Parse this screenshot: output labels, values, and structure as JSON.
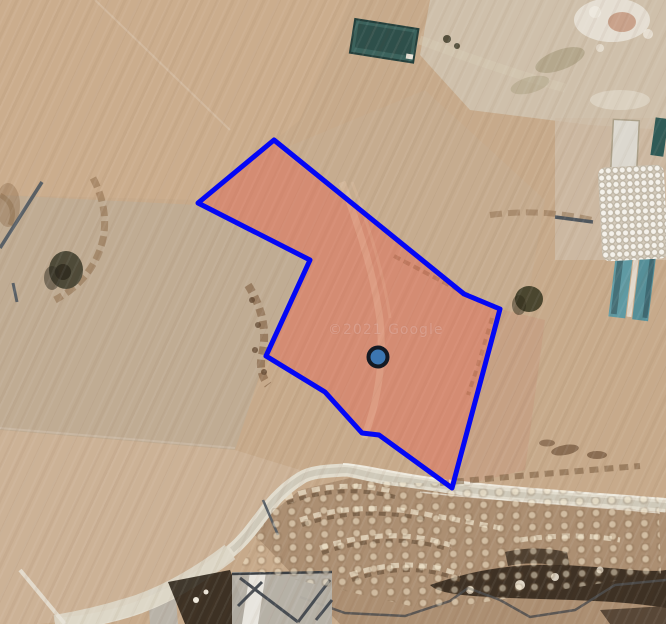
{
  "map": {
    "watermark": "©2021 Google",
    "overlay": {
      "parcel_polygon": {
        "points": [
          [
            274,
            140
          ],
          [
            198,
            203
          ],
          [
            310,
            260
          ],
          [
            266,
            356
          ],
          [
            325,
            392
          ],
          [
            362,
            433
          ],
          [
            379,
            435
          ],
          [
            452,
            488
          ],
          [
            500,
            309
          ],
          [
            464,
            294
          ]
        ],
        "stroke_color": "#0407f5",
        "fill_color": "rgba(248,95,75,0.25)",
        "stroke_width": 5
      },
      "marker": {
        "x": 378,
        "y": 357,
        "radius": 9.5,
        "fill_color": "#3c76b1",
        "border_color": "#131a24",
        "border_width": 4
      }
    }
  }
}
